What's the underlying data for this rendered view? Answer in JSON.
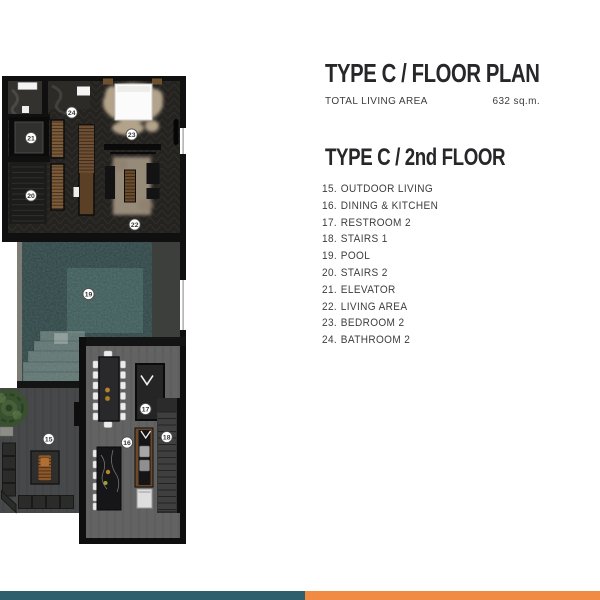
{
  "header": {
    "title": "TYPE C / FLOOR PLAN",
    "area_label": "TOTAL LIVING AREA",
    "area_value": "632 sq.m."
  },
  "section": {
    "title": "TYPE C / 2nd FLOOR"
  },
  "legend": {
    "items": [
      {
        "no": "15.",
        "label": "OUTDOOR LIVING"
      },
      {
        "no": "16.",
        "label": "DINING & KITCHEN"
      },
      {
        "no": "17.",
        "label": "RESTROOM 2"
      },
      {
        "no": "18.",
        "label": "STAIRS 1"
      },
      {
        "no": "19.",
        "label": "POOL"
      },
      {
        "no": "20.",
        "label": "STAIRS 2"
      },
      {
        "no": "21.",
        "label": "ELEVATOR"
      },
      {
        "no": "22.",
        "label": "LIVING AREA"
      },
      {
        "no": "23.",
        "label": "BEDROOM 2"
      },
      {
        "no": "24.",
        "label": "BATHROOM 2"
      }
    ]
  },
  "plan": {
    "markers": [
      {
        "n": "15"
      },
      {
        "n": "16"
      },
      {
        "n": "17"
      },
      {
        "n": "18"
      },
      {
        "n": "19"
      },
      {
        "n": "20"
      },
      {
        "n": "21"
      },
      {
        "n": "22"
      },
      {
        "n": "23"
      },
      {
        "n": "24"
      }
    ],
    "colors": {
      "wall": "#101010",
      "upper_floor": "#242320",
      "pool_water": "#2c4344",
      "dining_floor": "#636363",
      "outdoor_floor": "#47484a",
      "wood": "#7d5c3a",
      "gold_accent": "#b3862e"
    }
  },
  "footer": {
    "stripes": [
      {
        "name": "teal",
        "color": "#2e5f6c"
      },
      {
        "name": "orange",
        "color": "#f18a43"
      }
    ]
  }
}
